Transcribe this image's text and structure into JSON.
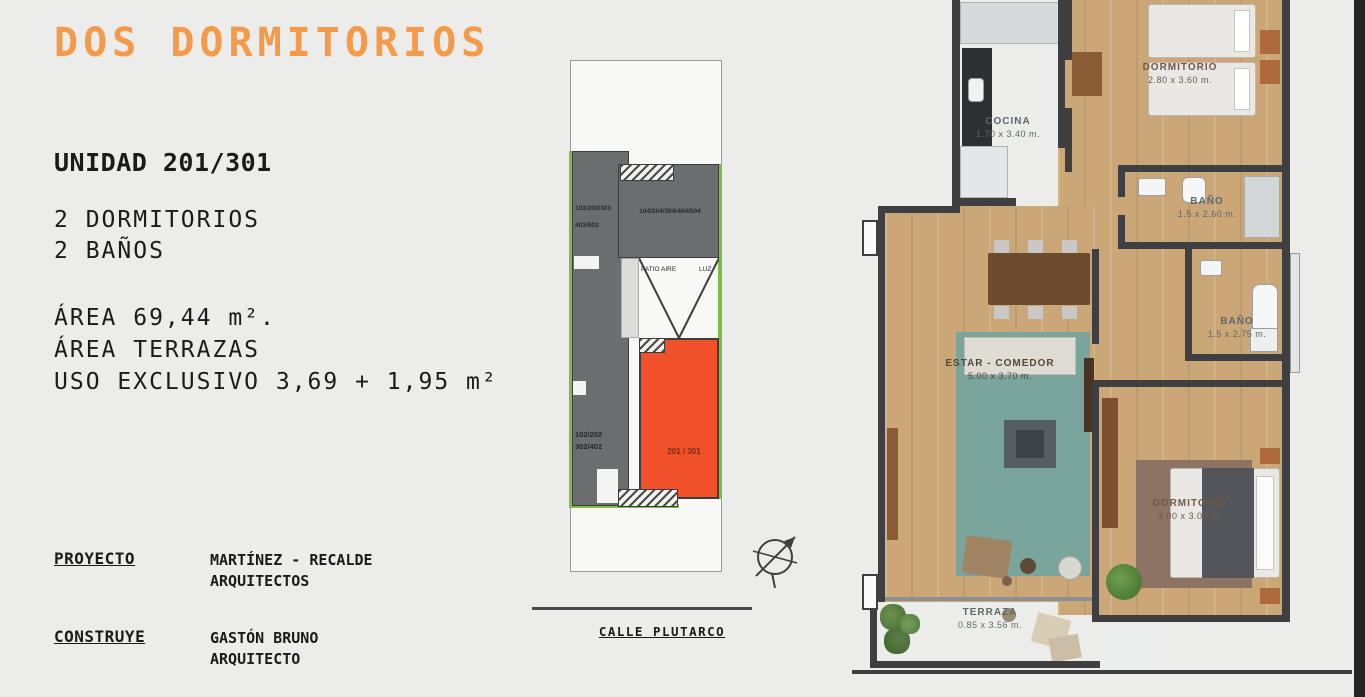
{
  "header": {
    "title": "DOS DORMITORIOS",
    "title_color": "#F49B4B"
  },
  "unit_info": {
    "unit": "UNIDAD 201/301",
    "features": [
      "2 DORMITORIOS",
      "2 BAÑOS"
    ],
    "area_lines": [
      "ÁREA 69,44 m².",
      "ÁREA TERRAZAS",
      "USO EXCLUSIVO 3,69 + 1,95 m²"
    ]
  },
  "credits": [
    {
      "role": "PROYECTO",
      "name_lines": [
        "MARTÍNEZ - RECALDE",
        "ARQUITECTOS"
      ]
    },
    {
      "role": "CONSTRUYE",
      "name_lines": [
        "GASTÓN BRUNO",
        "ARQUITECTO"
      ]
    }
  ],
  "site_plan": {
    "street_label": "CALLE PLUTARCO",
    "patio_label_left": "PATIO AIRE",
    "patio_label_right": "LUZ",
    "stack_103": {
      "lines": [
        "103/203/303",
        "403/503"
      ]
    },
    "stack_104": {
      "label": "104/204/304/404/504"
    },
    "stack_102": {
      "lines": [
        "102/202",
        "302/402"
      ]
    },
    "highlight": {
      "label": "201 / 301",
      "color": "#F0512B"
    },
    "icons": [
      "north-compass-icon"
    ]
  },
  "floor_plan": {
    "rooms": [
      {
        "id": "cocina",
        "name": "COCINA",
        "dims": "1.70 x 3.40 m."
      },
      {
        "id": "dormitorio-1",
        "name": "DORMITORIO",
        "dims": "2.80 x 3.60 m."
      },
      {
        "id": "bano-1",
        "name": "BAÑO",
        "dims": "1.5 x 2.60 m."
      },
      {
        "id": "bano-2",
        "name": "BAÑO",
        "dims": "1.5 x 2.75 m."
      },
      {
        "id": "estar-comedor",
        "name": "ESTAR - COMEDOR",
        "dims": "5.00 x 3.70 m."
      },
      {
        "id": "dormitorio-2",
        "name": "DORMITORIO",
        "dims": "3.00 x 3.00 m."
      },
      {
        "id": "terraza",
        "name": "TERRAZA",
        "dims": "0.85 x 3.56 m."
      }
    ]
  },
  "colors": {
    "accent_orange": "#F49B4B",
    "highlight_unit": "#F0512B",
    "site_gray": "#6B6D6F",
    "site_green": "#7CC043",
    "wall": "#3F3F41",
    "rug_teal": "#7AA59C"
  }
}
